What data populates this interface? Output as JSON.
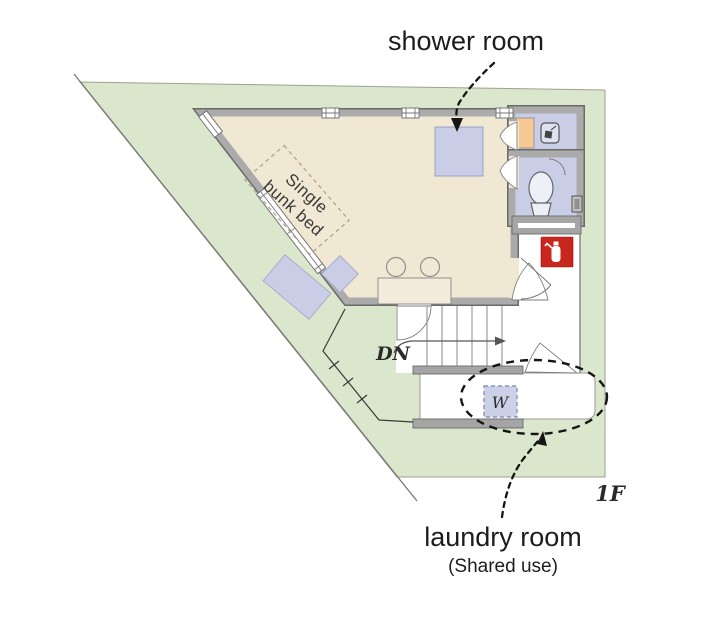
{
  "plan": {
    "floor_label": "1F",
    "annotations": {
      "shower_room": "shower room",
      "laundry_room": "laundry room",
      "laundry_note": "(Shared use)"
    },
    "room_items": {
      "bed_line1": "Single",
      "bed_line2": "bunk bed",
      "stairs_direction": "DN",
      "washer": "W"
    },
    "colors": {
      "lot_green": "#dbe7cc",
      "floor_beige": "#f1e8d4",
      "wall_gray": "#ababab",
      "wall_outline": "#6a6a6a",
      "fixture_lavender": "#c9cde6",
      "counter_orange": "#f7c893",
      "extinguisher_red": "#c9271e",
      "annotation_black": "#151515"
    }
  }
}
